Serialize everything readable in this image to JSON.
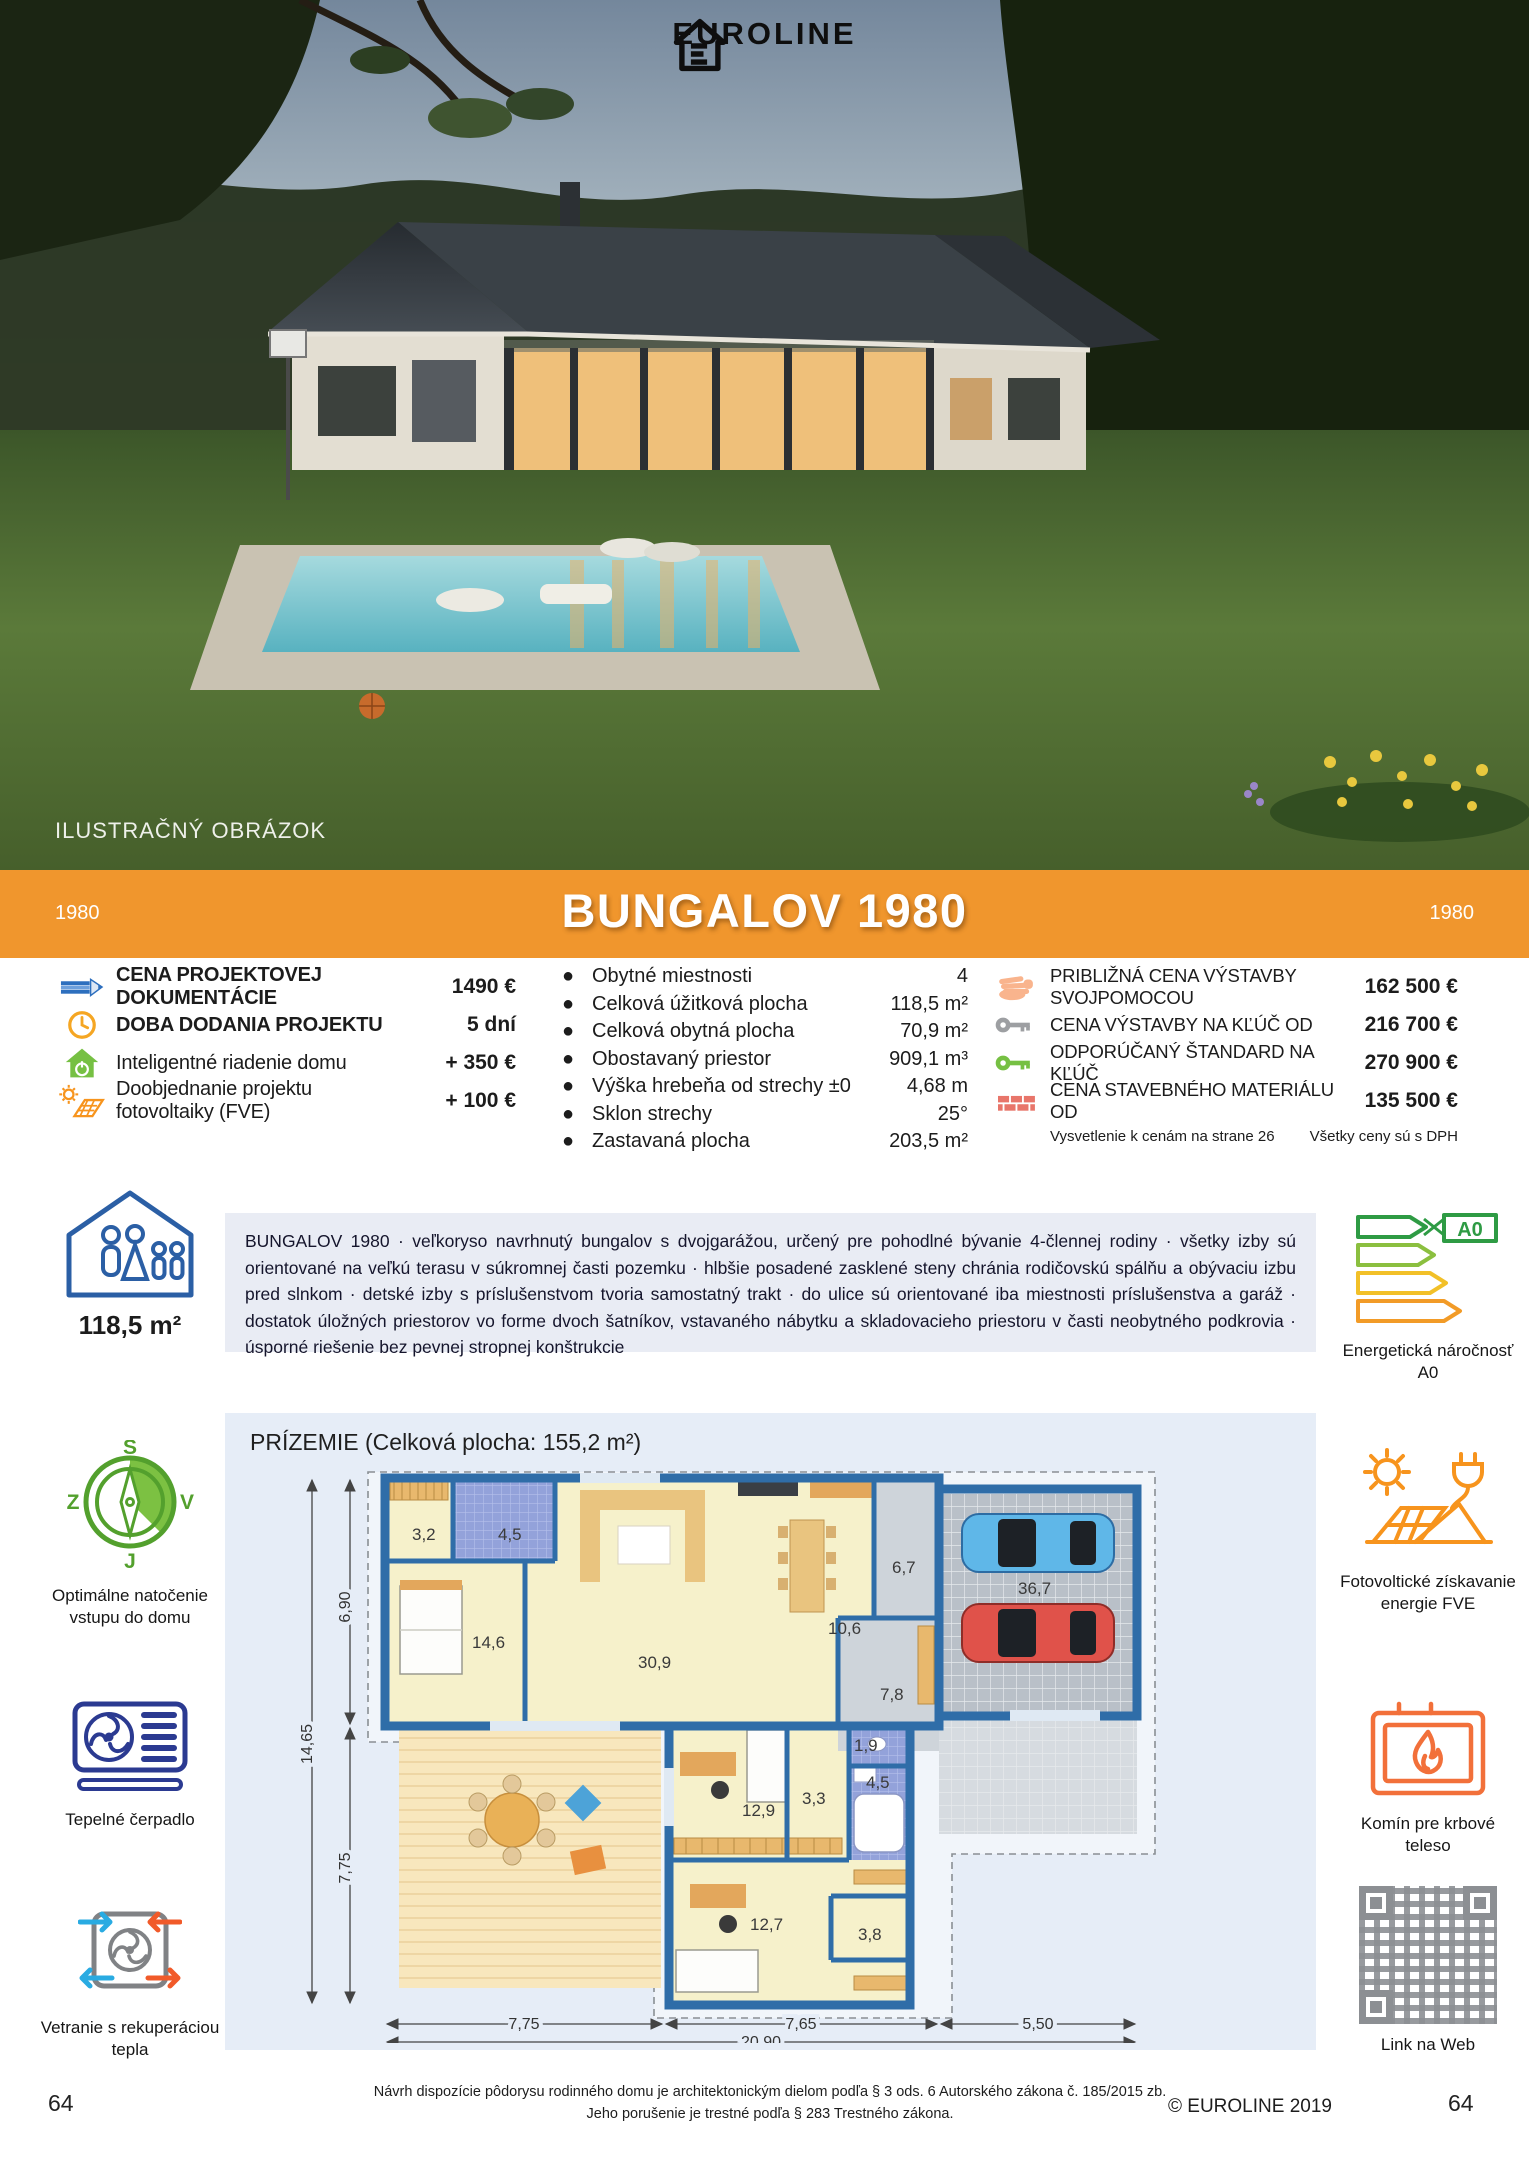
{
  "colors": {
    "banner_orange": "#f0962d",
    "wall_blue": "#2f6da8",
    "energy_green": "#2e9b44"
  },
  "hero": {
    "brand": "EUROLINE",
    "caption": "ILUSTRAČNÝ OBRÁZOK"
  },
  "banner": {
    "title": "BUNGALOV 1980",
    "code_left": "1980",
    "code_right": "1980"
  },
  "pricing_left": {
    "items": [
      {
        "icon": "pencil-icon",
        "label": "CENA PROJEKTOVEJ DOKUMENTÁCIE",
        "value": "1490 €"
      },
      {
        "icon": "clock-icon",
        "label": "DOBA DODANIA PROJEKTU",
        "value": "5 dní"
      },
      {
        "icon": "smart-home-icon",
        "label": "Inteligentné riadenie domu",
        "value": "+ 350 €"
      },
      {
        "icon": "solar-order-icon",
        "label": "Doobjednanie projektu fotovoltaiky (FVE)",
        "value": "+ 100 €"
      }
    ]
  },
  "specs": {
    "items": [
      {
        "label": "Obytné miestnosti",
        "value": "4"
      },
      {
        "label": "Celková úžitková plocha",
        "value": "118,5 m²"
      },
      {
        "label": "Celková obytná plocha",
        "value": "70,9 m²"
      },
      {
        "label": "Obostavaný priestor",
        "value": "909,1 m³"
      },
      {
        "label": "Výška hrebeňa od strechy ±0",
        "value": "4,68 m"
      },
      {
        "label": "Sklon strechy",
        "value": "25°"
      },
      {
        "label": "Zastavaná plocha",
        "value": "203,5 m²"
      }
    ]
  },
  "pricing_right": {
    "items": [
      {
        "icon": "hand-icon",
        "label": "PRIBLIŽNÁ CENA VÝSTAVBY SVOJPOMOCOU",
        "value": "162 500 €"
      },
      {
        "icon": "key-gray-icon",
        "label": "CENA VÝSTAVBY NA KĽÚČ OD",
        "value": "216 700 €"
      },
      {
        "icon": "key-green-icon",
        "label": "ODPORÚČANÝ ŠTANDARD NA KĽÚČ",
        "value": "270 900 €"
      },
      {
        "icon": "bricks-icon",
        "label": "CENA STAVEBNÉHO MATERIÁLU OD",
        "value": "135 500 €"
      }
    ],
    "note_left": "Vysvetlenie k cenám na strane 26",
    "note_right": "Všetky ceny sú s DPH"
  },
  "description": {
    "text": "BUNGALOV 1980 · veľkoryso navrhnutý bungalov s dvojgarážou, určený pre pohodlné bývanie 4-člennej rodiny · všetky izby sú orientované na veľkú terasu v súkromnej časti pozemku · hlbšie posadené zasklené steny chránia rodičovskú spálňu a obývaciu izbu pred slnkom · detské izby s príslušenstvom tvoria samostatný trakt · do ulice sú orientované iba miestnosti príslušenstva a garáž · dostatok úložných priestorov vo forme dvoch šatníkov, vstavaného nábytku a skladovacieho priestoru v časti neobytného podkrovia · úsporné riešenie bez pevnej stropnej konštrukcie"
  },
  "badges_left": {
    "area": "118,5 m²",
    "compass": {
      "n": "S",
      "e": "V",
      "s": "J",
      "w": "Z"
    },
    "compass_label": "Optimálne natočenie vstupu do domu",
    "heatpump_label": "Tepelné čerpadlo",
    "vent_label": "Vetranie s rekuperáciou tepla"
  },
  "badges_right": {
    "energy_badge": "A0",
    "energy_label": "Energetická náročnosť A0",
    "pv_label": "Fotovoltické získavanie energie FVE",
    "fireplace_label": "Komín pre krbové teleso",
    "qr_label": "Link na Web"
  },
  "floorplan": {
    "title": "PRÍZEMIE (Celková plocha: 155,2 m²)",
    "rooms": [
      {
        "area": "3,2"
      },
      {
        "area": "4,5"
      },
      {
        "area": "14,6"
      },
      {
        "area": "30,9"
      },
      {
        "area": "10,6"
      },
      {
        "area": "6,7"
      },
      {
        "area": "36,7"
      },
      {
        "area": "7,8"
      },
      {
        "area": "1,9"
      },
      {
        "area": "12,9"
      },
      {
        "area": "3,3"
      },
      {
        "area": "4,5"
      },
      {
        "area": "12,7"
      },
      {
        "area": "3,8"
      }
    ],
    "dims": {
      "left_top": "6,90",
      "left_total": "14,65",
      "left_bottom": "7,75",
      "bottom_1": "7,75",
      "bottom_2": "7,65",
      "bottom_3": "5,50",
      "bottom_total": "20,90"
    }
  },
  "page": {
    "legal_line1": "Návrh dispozície pôdorysu rodinného domu je architektonickým dielom podľa § 3 ods. 6 Autorského zákona č. 185/2015 zb.",
    "legal_line2": "Jeho porušenie je trestné podľa § 283 Trestného zákona.",
    "copyright": "© EUROLINE 2019",
    "page_left": "64",
    "page_right": "64"
  }
}
